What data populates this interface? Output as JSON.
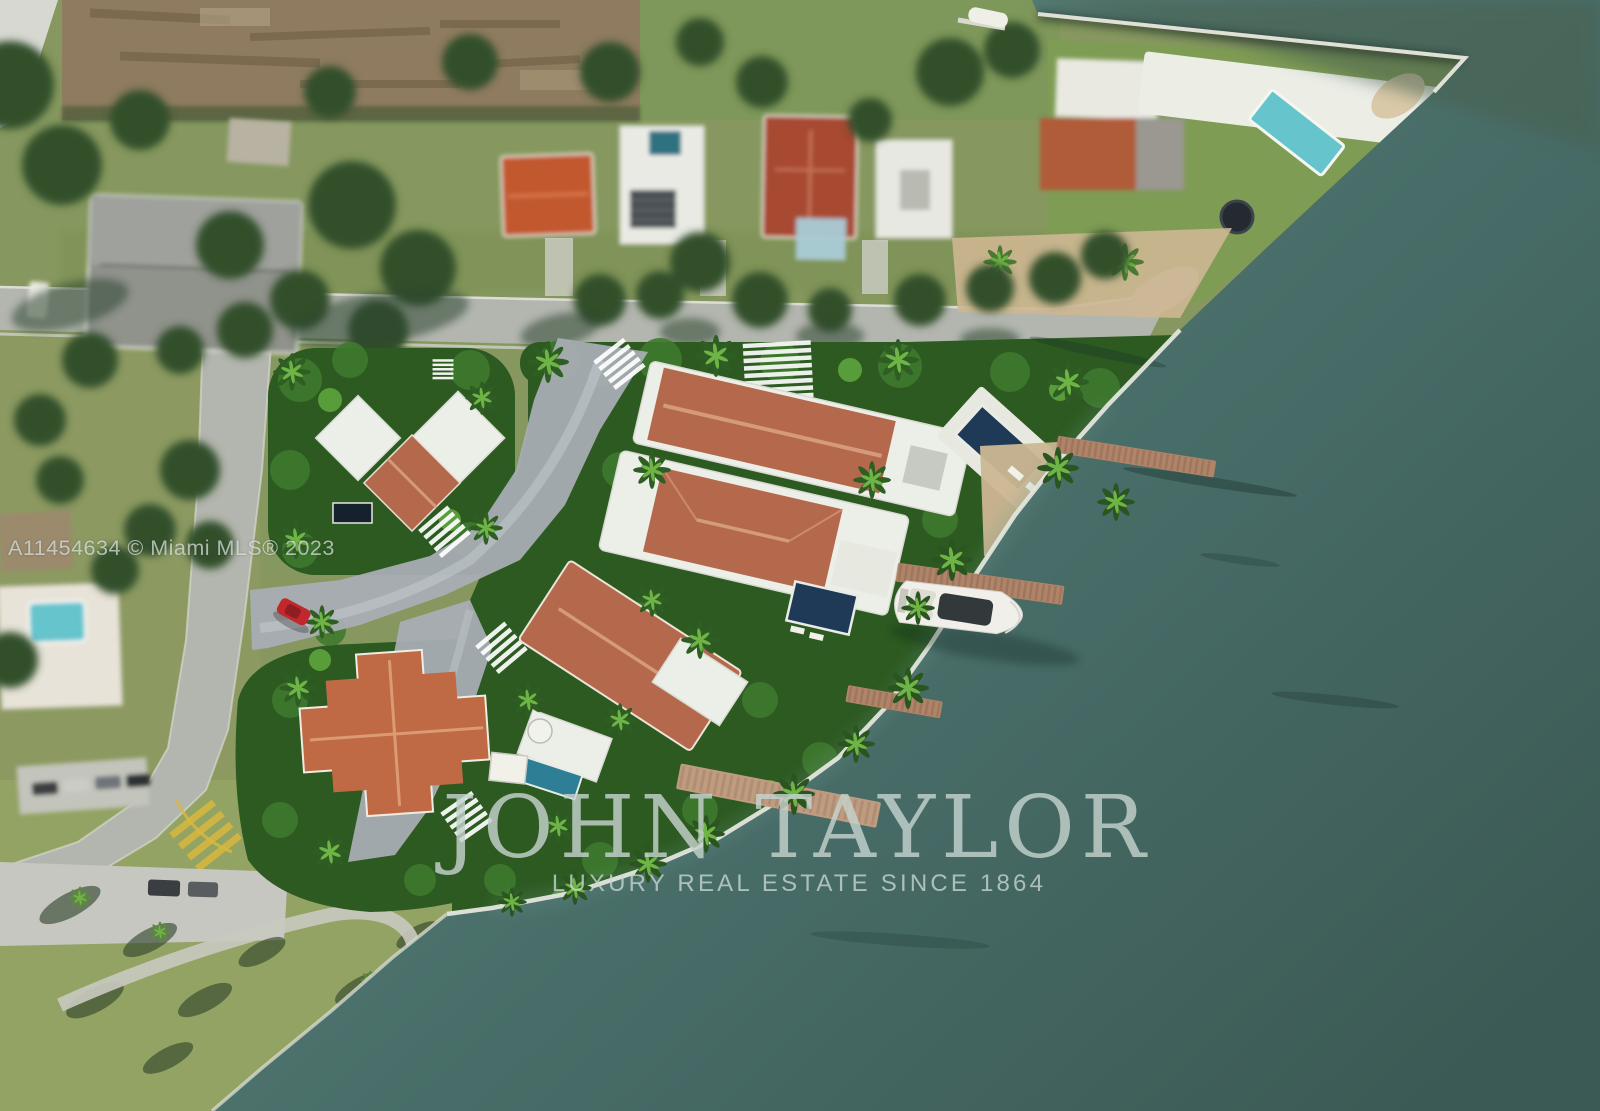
{
  "watermarks": {
    "listing": "A11454634 © Miami MLS® 2023",
    "brand": "JOHN TAYLOR",
    "tagline": "LUXURY REAL ESTATE SINCE 1864"
  },
  "colors": {
    "water_deep": "#3c5a55",
    "water_mid": "#486d68",
    "water_near": "#587f78",
    "water_olive": "#4a6150",
    "lush_dark": "#2c5a20",
    "lush_green": "#3f7a2e",
    "lush_light": "#63a83f",
    "sat_grass": "#86985f",
    "tree_dark": "#33502c",
    "road_gray": "#b3b6ae",
    "paver_gray": "#a8adb3",
    "dirt_brown": "#8f7c60",
    "sand_tan": "#cdb792",
    "roof_terracotta": "#b5694c",
    "roof_terracotta_light": "#d49a7c",
    "roof_orange": "#c2582f",
    "roof_red": "#a84a33",
    "roof_gray": "#90928c",
    "white_structure": "#eceee8",
    "pool_navy": "#1f3a57",
    "pool_turquoise": "#66c4cd",
    "pool_teal": "#2e7f96",
    "dock_wood": "#b08468",
    "dock_wood_light": "#bf9c80",
    "yacht_white": "#f0efe9",
    "car_red": "#c1272d",
    "marking_yellow": "#d9b93e",
    "seawall_white": "#e3e6dc"
  }
}
